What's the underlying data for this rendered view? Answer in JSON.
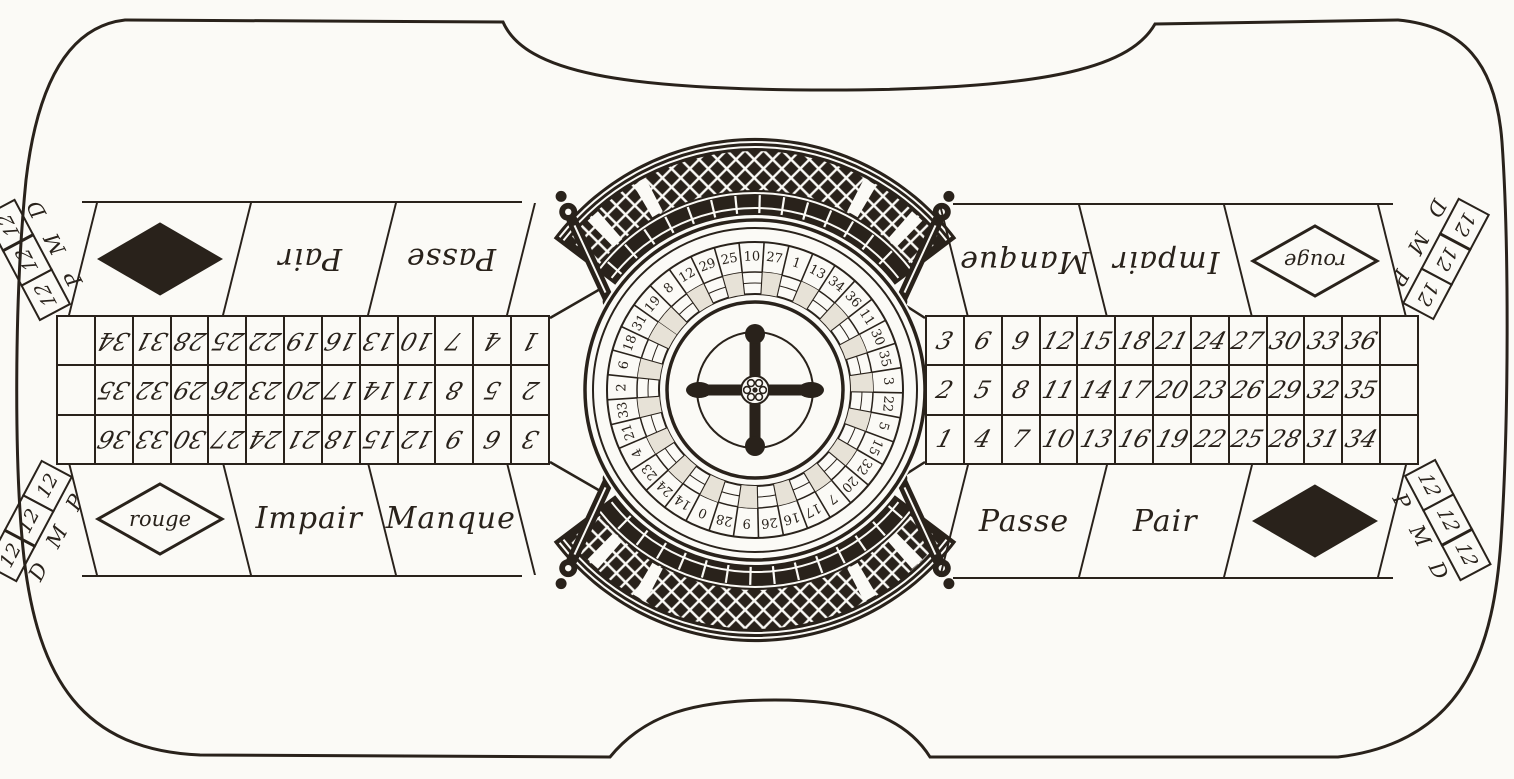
{
  "artwork": {
    "type": "vintage engraving",
    "subject": "double-ended French roulette table with central wheel"
  },
  "colors": {
    "paper": "#fbfaf6",
    "ink": "#29221b"
  },
  "betting_layout": {
    "rows": [
      [
        "3",
        "6",
        "9",
        "12",
        "15",
        "18",
        "21",
        "24",
        "27",
        "30",
        "33",
        "36",
        ""
      ],
      [
        "2",
        "5",
        "8",
        "11",
        "14",
        "17",
        "20",
        "23",
        "26",
        "29",
        "32",
        "35",
        ""
      ],
      [
        "1",
        "4",
        "7",
        "10",
        "13",
        "16",
        "19",
        "22",
        "25",
        "28",
        "31",
        "34",
        ""
      ]
    ],
    "outer_band": {
      "manque": "Manque",
      "impair": "Impair",
      "rouge": "rouge"
    },
    "inner_band": {
      "passe": "Passe",
      "pair": "Pair"
    },
    "dozens": {
      "cells": [
        "12",
        "12",
        "12"
      ],
      "letters": [
        "P",
        "M",
        "D"
      ]
    }
  },
  "wheel": {
    "ring_numbers": [
      "19",
      "8",
      "12",
      "29",
      "25",
      "10",
      "27",
      "1",
      "13",
      "34",
      "36",
      "11",
      "30",
      "35",
      "3",
      "22",
      "5",
      "15",
      "32",
      "20",
      "7",
      "17",
      "16",
      "26",
      "9",
      "28",
      "0",
      "14",
      "24",
      "23",
      "4",
      "21",
      "33",
      "2",
      "6",
      "18",
      "31"
    ]
  }
}
